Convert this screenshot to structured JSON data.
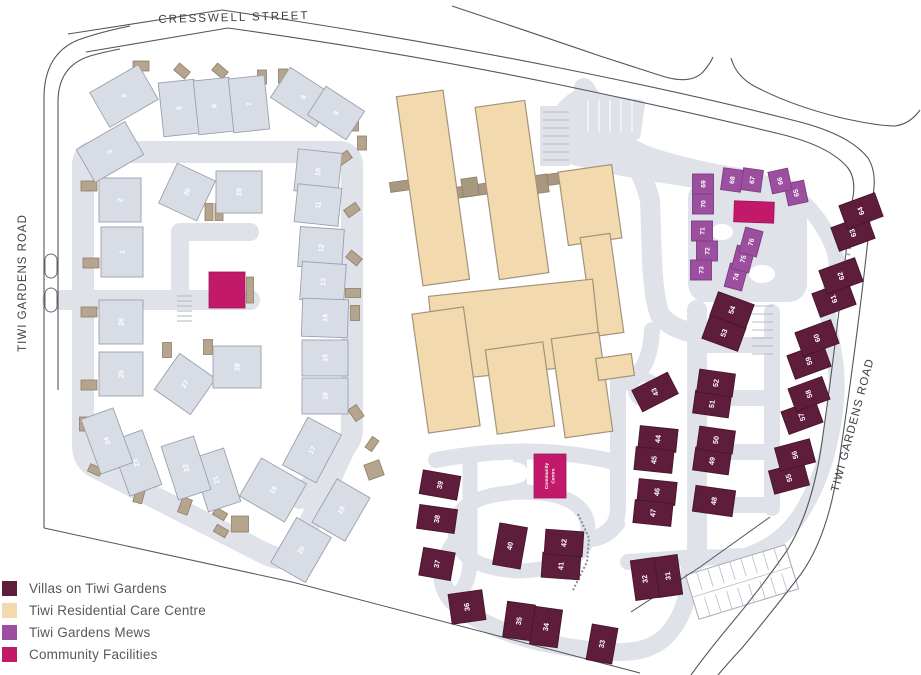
{
  "colors": {
    "villas": "#5E1D3B",
    "care": "#F2D9AE",
    "mews": "#9C4F9F",
    "community": "#C2196B",
    "gray_building": "#D8DCE5",
    "gray_building_stroke": "#9AA0AE",
    "villas_stroke": "#47152D",
    "mews_stroke": "#7C3E82",
    "community_stroke": "#9E1458",
    "care_stroke": "#A3937B",
    "care_connector": "#A89880",
    "road": "#DFE2E9",
    "shed": "#B6A58E",
    "shed_stroke": "#8F7E66",
    "outline": "#55565E",
    "parking_line": "#B8BCC8",
    "legend_text": "#57585A",
    "street_text": "#3E3E46"
  },
  "legend": {
    "items": [
      {
        "label": "Villas on Tiwi Gardens",
        "key": "villas"
      },
      {
        "label": "Tiwi Residential Care Centre",
        "key": "care"
      },
      {
        "label": "Tiwi Gardens Mews",
        "key": "mews"
      },
      {
        "label": "Community Facilities",
        "key": "community"
      }
    ]
  },
  "map": {
    "street_labels": [
      {
        "text": "CRESSWELL STREET",
        "x": 234,
        "y": 21,
        "r": -1.5,
        "size": 11.5,
        "ls": 2
      },
      {
        "text": "TIWI GARDENS ROAD",
        "x": 26,
        "y": 283,
        "r": -90,
        "size": 11.5,
        "ls": 1
      },
      {
        "text": "TIWI GARDENS ROAD",
        "x": 856,
        "y": 426,
        "r": -75,
        "size": 11.5,
        "ls": 1
      }
    ],
    "road_fills": [
      {
        "type": "path",
        "d": "M 545 132 Q 552 104 572 92 L 585 86 Q 598 104 612 120 Q 632 142 660 150 Q 700 162 740 168 L 796 184 L 798 204 Q 750 196 710 190 Q 652 182 612 174 Q 572 166 552 158 Z"
      },
      {
        "type": "rect",
        "x": 688,
        "y": 180,
        "w": 119,
        "h": 122,
        "rx": 18,
        "r": 0
      },
      {
        "type": "rect",
        "x": 583,
        "y": 96,
        "w": 60,
        "h": 40,
        "rx": 4,
        "r": 8
      },
      {
        "type": "rect",
        "x": 540,
        "y": 106,
        "w": 30,
        "h": 60,
        "rx": 2,
        "r": 0
      },
      {
        "type": "circle",
        "cx": 645,
        "cy": 390,
        "r": 17
      }
    ],
    "roads": [
      {
        "d": "M 83 298 L 83 165 Q 83 152 96 152 L 338 152 Q 352 152 352 166 L 352 428 Q 352 440 344 448 L 300 498",
        "w": 22
      },
      {
        "d": "M 83 298 L 83 445 Q 83 462 97 468 L 262 552 Q 288 566 298 548 L 344 449",
        "w": 22
      },
      {
        "d": "M 52 300 L 250 300",
        "w": 20
      },
      {
        "d": "M 180 300 L 180 232 L 250 232",
        "w": 18
      },
      {
        "d": "M 584 88 Q 600 112 618 136 Q 642 168 650 200 L 652 262 Q 654 300 660 315 Q 672 330 697 333",
        "w": 20
      },
      {
        "d": "M 697 310 L 697 560",
        "w": 20
      },
      {
        "d": "M 697 345 L 772 345",
        "w": 16
      },
      {
        "d": "M 697 398 L 772 398",
        "w": 16
      },
      {
        "d": "M 697 452 L 772 452",
        "w": 16
      },
      {
        "d": "M 697 505 L 772 505",
        "w": 16
      },
      {
        "d": "M 772 312 L 772 508",
        "w": 16
      },
      {
        "d": "M 618 378 L 618 508 Q 618 528 600 536",
        "w": 16
      },
      {
        "d": "M 652 330 Q 650 378 618 385",
        "w": 16
      },
      {
        "d": "M 800 200 Q 818 215 830 240 Q 842 262 832 285 Q 825 300 830 330 L 835 360 Q 840 395 830 440 Q 822 480 800 515 Q 780 545 745 556 L 700 558",
        "w": 16
      },
      {
        "d": "M 455 530 Q 455 495 520 492 Q 588 492 588 530 Q 588 568 520 571 Q 455 568 455 530",
        "w": 15
      },
      {
        "d": "M 520 492 L 520 460",
        "w": 14
      },
      {
        "d": "M 588 540 Q 606 540 618 524",
        "w": 14
      },
      {
        "d": "M 455 540 Q 445 552 442 568",
        "w": 14
      },
      {
        "d": "M 436 460 Q 530 442 615 462",
        "w": 16
      },
      {
        "d": "M 470 462 L 470 560 Q 470 588 452 598",
        "w": 15
      },
      {
        "d": "M 442 568 Q 440 592 460 608 Q 490 630 540 642 Q 590 652 620 652 Q 652 652 668 634 Q 682 618 687 596 Q 690 580 690 560",
        "w": 18
      },
      {
        "d": "M 628 562 L 697 557",
        "w": 16
      },
      {
        "d": "M 687 596 Q 700 588 716 584",
        "w": 14
      }
    ],
    "islands": [
      {
        "cx": 514,
        "cy": 473,
        "rx": 14,
        "ry": 11
      },
      {
        "cx": 722,
        "cy": 232,
        "rx": 11,
        "ry": 8
      },
      {
        "cx": 762,
        "cy": 274,
        "rx": 13,
        "ry": 9
      },
      {
        "cx": 645,
        "cy": 390,
        "rx": 8,
        "ry": 8
      }
    ],
    "parking_groups": [
      {
        "x": 543,
        "y": 112,
        "len": 26,
        "n": 7,
        "gap": 8,
        "dir": "h",
        "color": "#B8BCC8"
      },
      {
        "x": 177,
        "y": 296,
        "len": 15,
        "n": 6,
        "gap": 5,
        "dir": "h",
        "color": "#B8BCC8"
      },
      {
        "x": 752,
        "y": 306,
        "len": 21,
        "n": 7,
        "gap": 8,
        "dir": "h",
        "color": "#B8BCC8"
      },
      {
        "x": 588,
        "y": 100,
        "len": 32,
        "n": 5,
        "gap": 11,
        "dir": "v",
        "color": "#FFFFFF"
      }
    ],
    "parking_lot": {
      "cx": 742,
      "cy": 582,
      "w": 104,
      "h": 46,
      "r": -17,
      "cols": 9
    },
    "street_lines": [
      "M 68 34 L 222 10 Q 400 36 560 68 Q 700 96 800 122 Q 850 135 868 158 Q 878 174 872 200",
      "M 86 52 L 228 28 Q 400 52 556 84 Q 690 112 780 134 Q 830 146 848 168 Q 857 180 852 202",
      "M 44 98 Q 44 54 78 40 Q 100 32 130 26",
      "M 58 102 Q 58 66 90 56 Q 104 52 120 49",
      "M 44 98 L 44 528",
      "M 58 102 L 58 390",
      "M 852 202 Q 846 252 840 302 Q 832 372 822 442 Q 812 512 786 552 Q 758 592 726 630 Q 706 654 691 675",
      "M 872 200 Q 866 262 857 332 Q 847 410 838 468 Q 828 536 801 574 Q 772 612 742 648 Q 728 663 718 675",
      "M 452 6 Q 530 32 600 56 L 662 76 Q 690 85 703 72 Q 710 64 713 57",
      "M 731 58 Q 736 76 754 86 Q 792 106 842 118 Q 878 126 895 126 Q 910 124 920 110"
    ],
    "boundaries": [
      "M 44 528 L 292 582 L 640 673",
      "M 770 517 L 700 567 L 631 612"
    ],
    "hatch": "M 853 212 Q 847 258 842 308",
    "medians": [
      [
        45,
        254,
        12,
        24
      ],
      [
        45,
        288,
        12,
        24
      ]
    ],
    "fence": "M 578 514 L 589 538 L 587 562 L 572 592",
    "care": {
      "shapes": [
        [
          433,
          188,
          47,
          191,
          -8
        ],
        [
          512,
          190,
          50,
          174,
          -8
        ],
        [
          590,
          205,
          54,
          74,
          -8
        ],
        [
          602,
          285,
          30,
          100,
          -8
        ],
        [
          515,
          330,
          165,
          85,
          -6
        ],
        [
          446,
          370,
          52,
          120,
          -8
        ],
        [
          520,
          388,
          58,
          85,
          -8
        ],
        [
          582,
          385,
          48,
          100,
          -8
        ],
        [
          615,
          367,
          36,
          22,
          -8
        ]
      ],
      "connectors": [
        [
          401,
          186,
          22,
          10,
          -8
        ],
        [
          505,
          186,
          112,
          11,
          -8
        ],
        [
          470,
          187,
          16,
          18,
          -8
        ],
        [
          540,
          184,
          16,
          18,
          -8
        ]
      ]
    },
    "sheds": [
      [
        141,
        66,
        16,
        10,
        0
      ],
      [
        182,
        71,
        14,
        9,
        40
      ],
      [
        220,
        71,
        14,
        9,
        40
      ],
      [
        262,
        77,
        9,
        14,
        0
      ],
      [
        283,
        76,
        9,
        14,
        0
      ],
      [
        354,
        124,
        9,
        14,
        0
      ],
      [
        362,
        143,
        9,
        14,
        0
      ],
      [
        344,
        158,
        14,
        9,
        -35
      ],
      [
        89,
        186,
        16,
        10,
        0
      ],
      [
        91,
        263,
        16,
        10,
        0
      ],
      [
        89,
        312,
        16,
        10,
        0
      ],
      [
        209,
        212,
        8,
        17,
        0
      ],
      [
        219,
        212,
        8,
        17,
        0
      ],
      [
        352,
        210,
        14,
        9,
        -35
      ],
      [
        354,
        258,
        14,
        9,
        40
      ],
      [
        353,
        293,
        15,
        9,
        0
      ],
      [
        355,
        313,
        9,
        15,
        0
      ],
      [
        89,
        385,
        16,
        10,
        0
      ],
      [
        84,
        424,
        9,
        14,
        0
      ],
      [
        167,
        350,
        9,
        15,
        0
      ],
      [
        208,
        347,
        9,
        15,
        0
      ],
      [
        95,
        470,
        13,
        8,
        25
      ],
      [
        139,
        496,
        9,
        14,
        15
      ],
      [
        185,
        506,
        10,
        16,
        20
      ],
      [
        220,
        514,
        13,
        8,
        30
      ],
      [
        221,
        531,
        13,
        8,
        30
      ],
      [
        240,
        524,
        17,
        16,
        0
      ],
      [
        356,
        413,
        10,
        14,
        -35
      ],
      [
        372,
        444,
        13,
        8,
        -55
      ],
      [
        374,
        470,
        16,
        16,
        -20
      ],
      [
        250,
        290,
        7,
        26,
        0
      ]
    ],
    "buildings": {
      "gray": [
        [
          "1",
          122,
          252,
          42,
          50,
          0
        ],
        [
          "2",
          120,
          200,
          42,
          44,
          0
        ],
        [
          "3",
          110,
          152,
          56,
          38,
          -30
        ],
        [
          "4",
          124,
          96,
          56,
          40,
          -30
        ],
        [
          "5",
          179,
          108,
          36,
          54,
          -6
        ],
        [
          "6",
          214,
          106,
          36,
          54,
          -6
        ],
        [
          "7",
          249,
          104,
          36,
          54,
          -6
        ],
        [
          "8",
          303,
          97,
          54,
          36,
          33
        ],
        [
          "9",
          336,
          113,
          46,
          34,
          33
        ],
        [
          "10",
          318,
          172,
          44,
          42,
          6
        ],
        [
          "11",
          318,
          205,
          44,
          38,
          6
        ],
        [
          "12",
          321,
          248,
          44,
          40,
          4
        ],
        [
          "13",
          323,
          282,
          44,
          38,
          4
        ],
        [
          "14",
          325,
          318,
          46,
          38,
          2
        ],
        [
          "15",
          325,
          358,
          46,
          36,
          0
        ],
        [
          "16",
          325,
          396,
          46,
          36,
          0
        ],
        [
          "17",
          312,
          450,
          38,
          54,
          28
        ],
        [
          "18",
          341,
          510,
          38,
          50,
          30
        ],
        [
          "19",
          273,
          490,
          52,
          44,
          30
        ],
        [
          "20",
          301,
          550,
          40,
          52,
          30
        ],
        [
          "21",
          216,
          480,
          34,
          56,
          -18
        ],
        [
          "22",
          186,
          468,
          34,
          56,
          -18
        ],
        [
          "23",
          136,
          463,
          34,
          58,
          -20
        ],
        [
          "24",
          107,
          441,
          34,
          58,
          -20
        ],
        [
          "25",
          121,
          374,
          44,
          44,
          0
        ],
        [
          "26",
          121,
          322,
          44,
          44,
          0
        ],
        [
          "27",
          185,
          384,
          44,
          44,
          35
        ],
        [
          "28",
          237,
          367,
          48,
          42,
          0
        ],
        [
          "29",
          239,
          192,
          46,
          42,
          0
        ],
        [
          "30",
          187,
          192,
          42,
          44,
          25
        ]
      ],
      "villas": [
        [
          "31",
          668,
          576,
          24,
          40,
          -8
        ],
        [
          "32",
          645,
          579,
          24,
          40,
          -8
        ],
        [
          "33",
          602,
          644,
          26,
          36,
          10
        ],
        [
          "34",
          546,
          627,
          28,
          38,
          8
        ],
        [
          "35",
          519,
          621,
          28,
          36,
          8
        ],
        [
          "36",
          467,
          607,
          34,
          30,
          -8
        ],
        [
          "37",
          437,
          564,
          32,
          28,
          10
        ],
        [
          "38",
          437,
          519,
          38,
          24,
          8
        ],
        [
          "39",
          440,
          485,
          38,
          24,
          10
        ],
        [
          "40",
          510,
          546,
          28,
          42,
          10
        ],
        [
          "41",
          561,
          566,
          38,
          25,
          4
        ],
        [
          "42",
          564,
          543,
          38,
          25,
          4
        ],
        [
          "43",
          655,
          392,
          40,
          24,
          -27
        ],
        [
          "44",
          658,
          439,
          38,
          23,
          6
        ],
        [
          "45",
          654,
          460,
          38,
          23,
          6
        ],
        [
          "46",
          657,
          492,
          38,
          23,
          6
        ],
        [
          "47",
          653,
          513,
          38,
          23,
          6
        ],
        [
          "48",
          714,
          501,
          40,
          26,
          8
        ],
        [
          "49",
          712,
          461,
          36,
          23,
          8
        ],
        [
          "50",
          716,
          440,
          36,
          23,
          8
        ],
        [
          "51",
          712,
          404,
          36,
          23,
          8
        ],
        [
          "52",
          716,
          383,
          36,
          23,
          8
        ],
        [
          "53",
          724,
          333,
          38,
          25,
          20
        ],
        [
          "54",
          732,
          310,
          38,
          25,
          20
        ],
        [
          "55",
          789,
          478,
          36,
          24,
          -15
        ],
        [
          "56",
          795,
          455,
          36,
          24,
          -15
        ],
        [
          "57",
          802,
          417,
          36,
          24,
          -20
        ],
        [
          "58",
          809,
          394,
          36,
          24,
          -20
        ],
        [
          "59",
          809,
          361,
          38,
          25,
          -20
        ],
        [
          "60",
          817,
          338,
          38,
          25,
          -20
        ],
        [
          "61",
          834,
          299,
          38,
          25,
          -20
        ],
        [
          "62",
          841,
          276,
          38,
          25,
          -20
        ],
        [
          "63",
          853,
          233,
          38,
          25,
          -20
        ],
        [
          "64",
          861,
          211,
          38,
          25,
          -20
        ]
      ],
      "mews": [
        [
          "65",
          796,
          193,
          20,
          22,
          -12
        ],
        [
          "66",
          780,
          181,
          20,
          22,
          -12
        ],
        [
          "67",
          752,
          180,
          20,
          22,
          8
        ],
        [
          "68",
          732,
          180,
          20,
          22,
          8
        ],
        [
          "69",
          703,
          184,
          21,
          20,
          0
        ],
        [
          "70",
          703,
          204,
          21,
          20,
          0
        ],
        [
          "71",
          702,
          231,
          21,
          20,
          0
        ],
        [
          "72",
          707,
          251,
          21,
          20,
          0
        ],
        [
          "73",
          701,
          270,
          21,
          20,
          0
        ],
        [
          "74",
          736,
          277,
          18,
          24,
          15
        ],
        [
          "75",
          743,
          259,
          18,
          24,
          15
        ],
        [
          "76",
          751,
          242,
          18,
          26,
          15
        ]
      ]
    },
    "community_blocks": [
      {
        "cx": 227,
        "cy": 290,
        "w": 36,
        "h": 36,
        "r": 0
      },
      {
        "cx": 754,
        "cy": 212,
        "w": 40,
        "h": 21,
        "r": 2
      },
      {
        "cx": 550,
        "cy": 476,
        "w": 32,
        "h": 44,
        "r": 0,
        "label": "Community Centre"
      }
    ]
  }
}
